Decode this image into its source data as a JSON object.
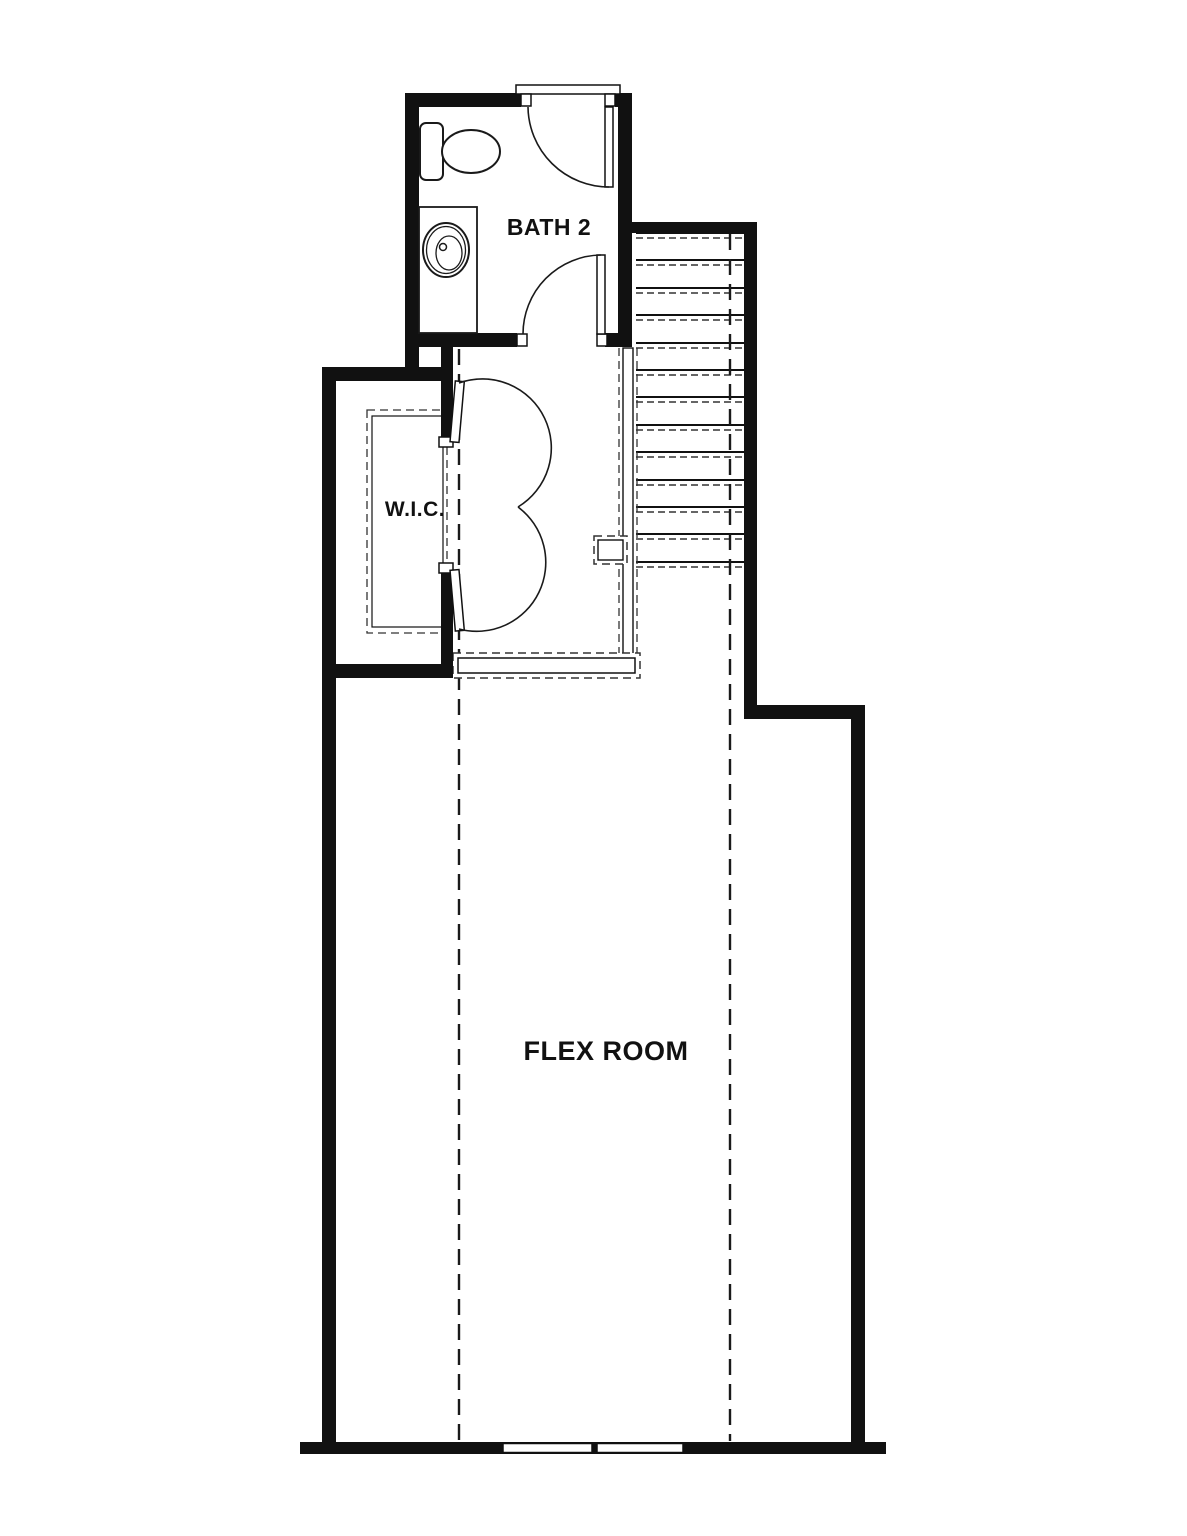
{
  "plan": {
    "background": "#ffffff",
    "colors": {
      "wall": "#111111",
      "line": "#1a1a1a",
      "dashed_line": "#333333",
      "text": "#111111"
    },
    "rooms": {
      "bath": {
        "label": "BATH 2"
      },
      "closet": {
        "label": "W.I.C."
      },
      "flex": {
        "label": "FLEX ROOM"
      }
    }
  }
}
